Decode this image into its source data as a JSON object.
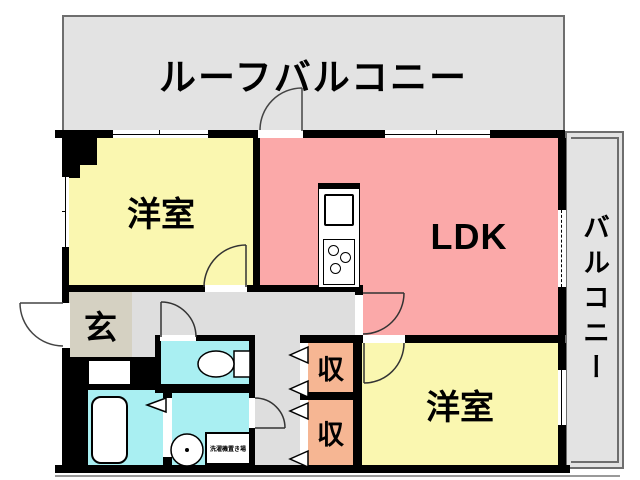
{
  "labels": {
    "roof_balcony": "ルーフバルコニー",
    "bedroom_top": "洋室",
    "ldk": "LDK",
    "balcony": "バルコニー",
    "entrance": "玄",
    "storage_top": "収",
    "storage_bottom": "収",
    "bedroom_bottom": "洋室",
    "laundry": "洗濯機置き場"
  },
  "colors": {
    "wall": "#000000",
    "bedroom": "#faf7b0",
    "ldk": "#fba9a9",
    "storage": "#f6b693",
    "wet": "#a9eff2",
    "entrance": "#d5d1c2",
    "hallway": "#dedede",
    "balcony": "#e3e3e3",
    "outline": "#6e6e6e"
  }
}
